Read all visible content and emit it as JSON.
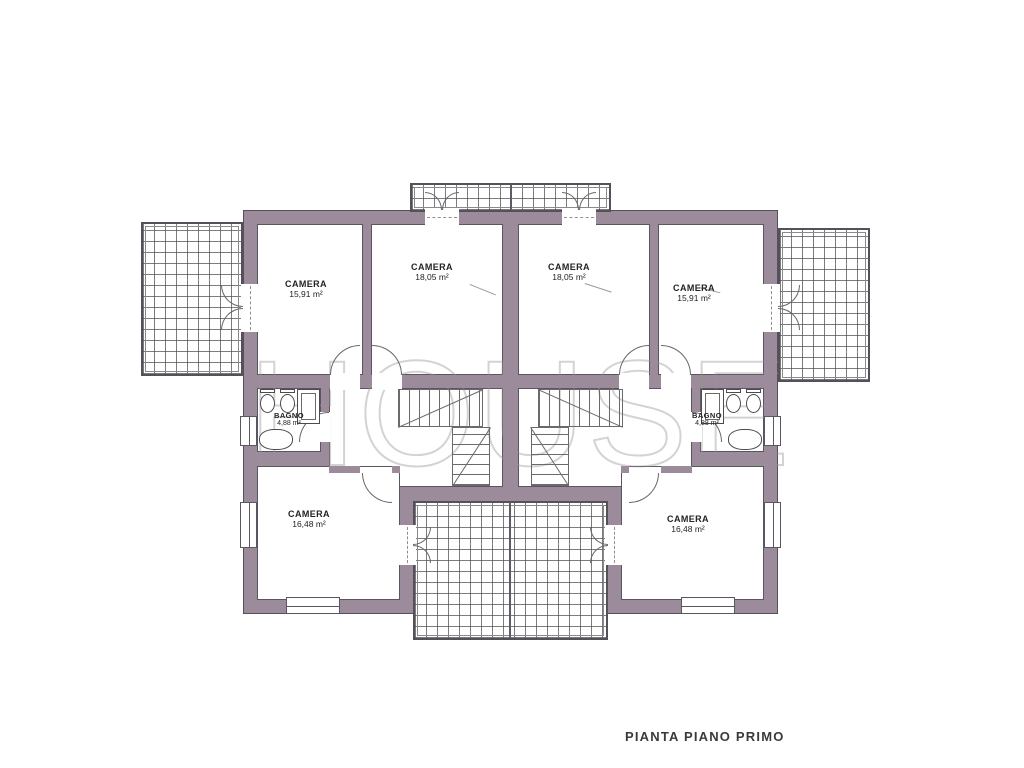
{
  "caption": "PIANTA PIANO PRIMO",
  "watermark": "HOUSE",
  "colors": {
    "wall": "#9c8b9a",
    "outline": "#56505a",
    "hatch_line": "#505050",
    "text": "#232323",
    "watermark_stroke": "#969696"
  },
  "rooms": [
    {
      "name": "CAMERA",
      "area": "15,91 m²"
    },
    {
      "name": "CAMERA",
      "area": "18,05 m²"
    },
    {
      "name": "CAMERA",
      "area": "18,05 m²"
    },
    {
      "name": "CAMERA",
      "area": "15,91 m²"
    },
    {
      "name": "BAGNO",
      "area": "4,88 m²"
    },
    {
      "name": "BAGNO",
      "area": "4,88 m²"
    },
    {
      "name": "CAMERA",
      "area": "16,48 m²"
    },
    {
      "name": "CAMERA",
      "area": "16,48 m²"
    }
  ]
}
